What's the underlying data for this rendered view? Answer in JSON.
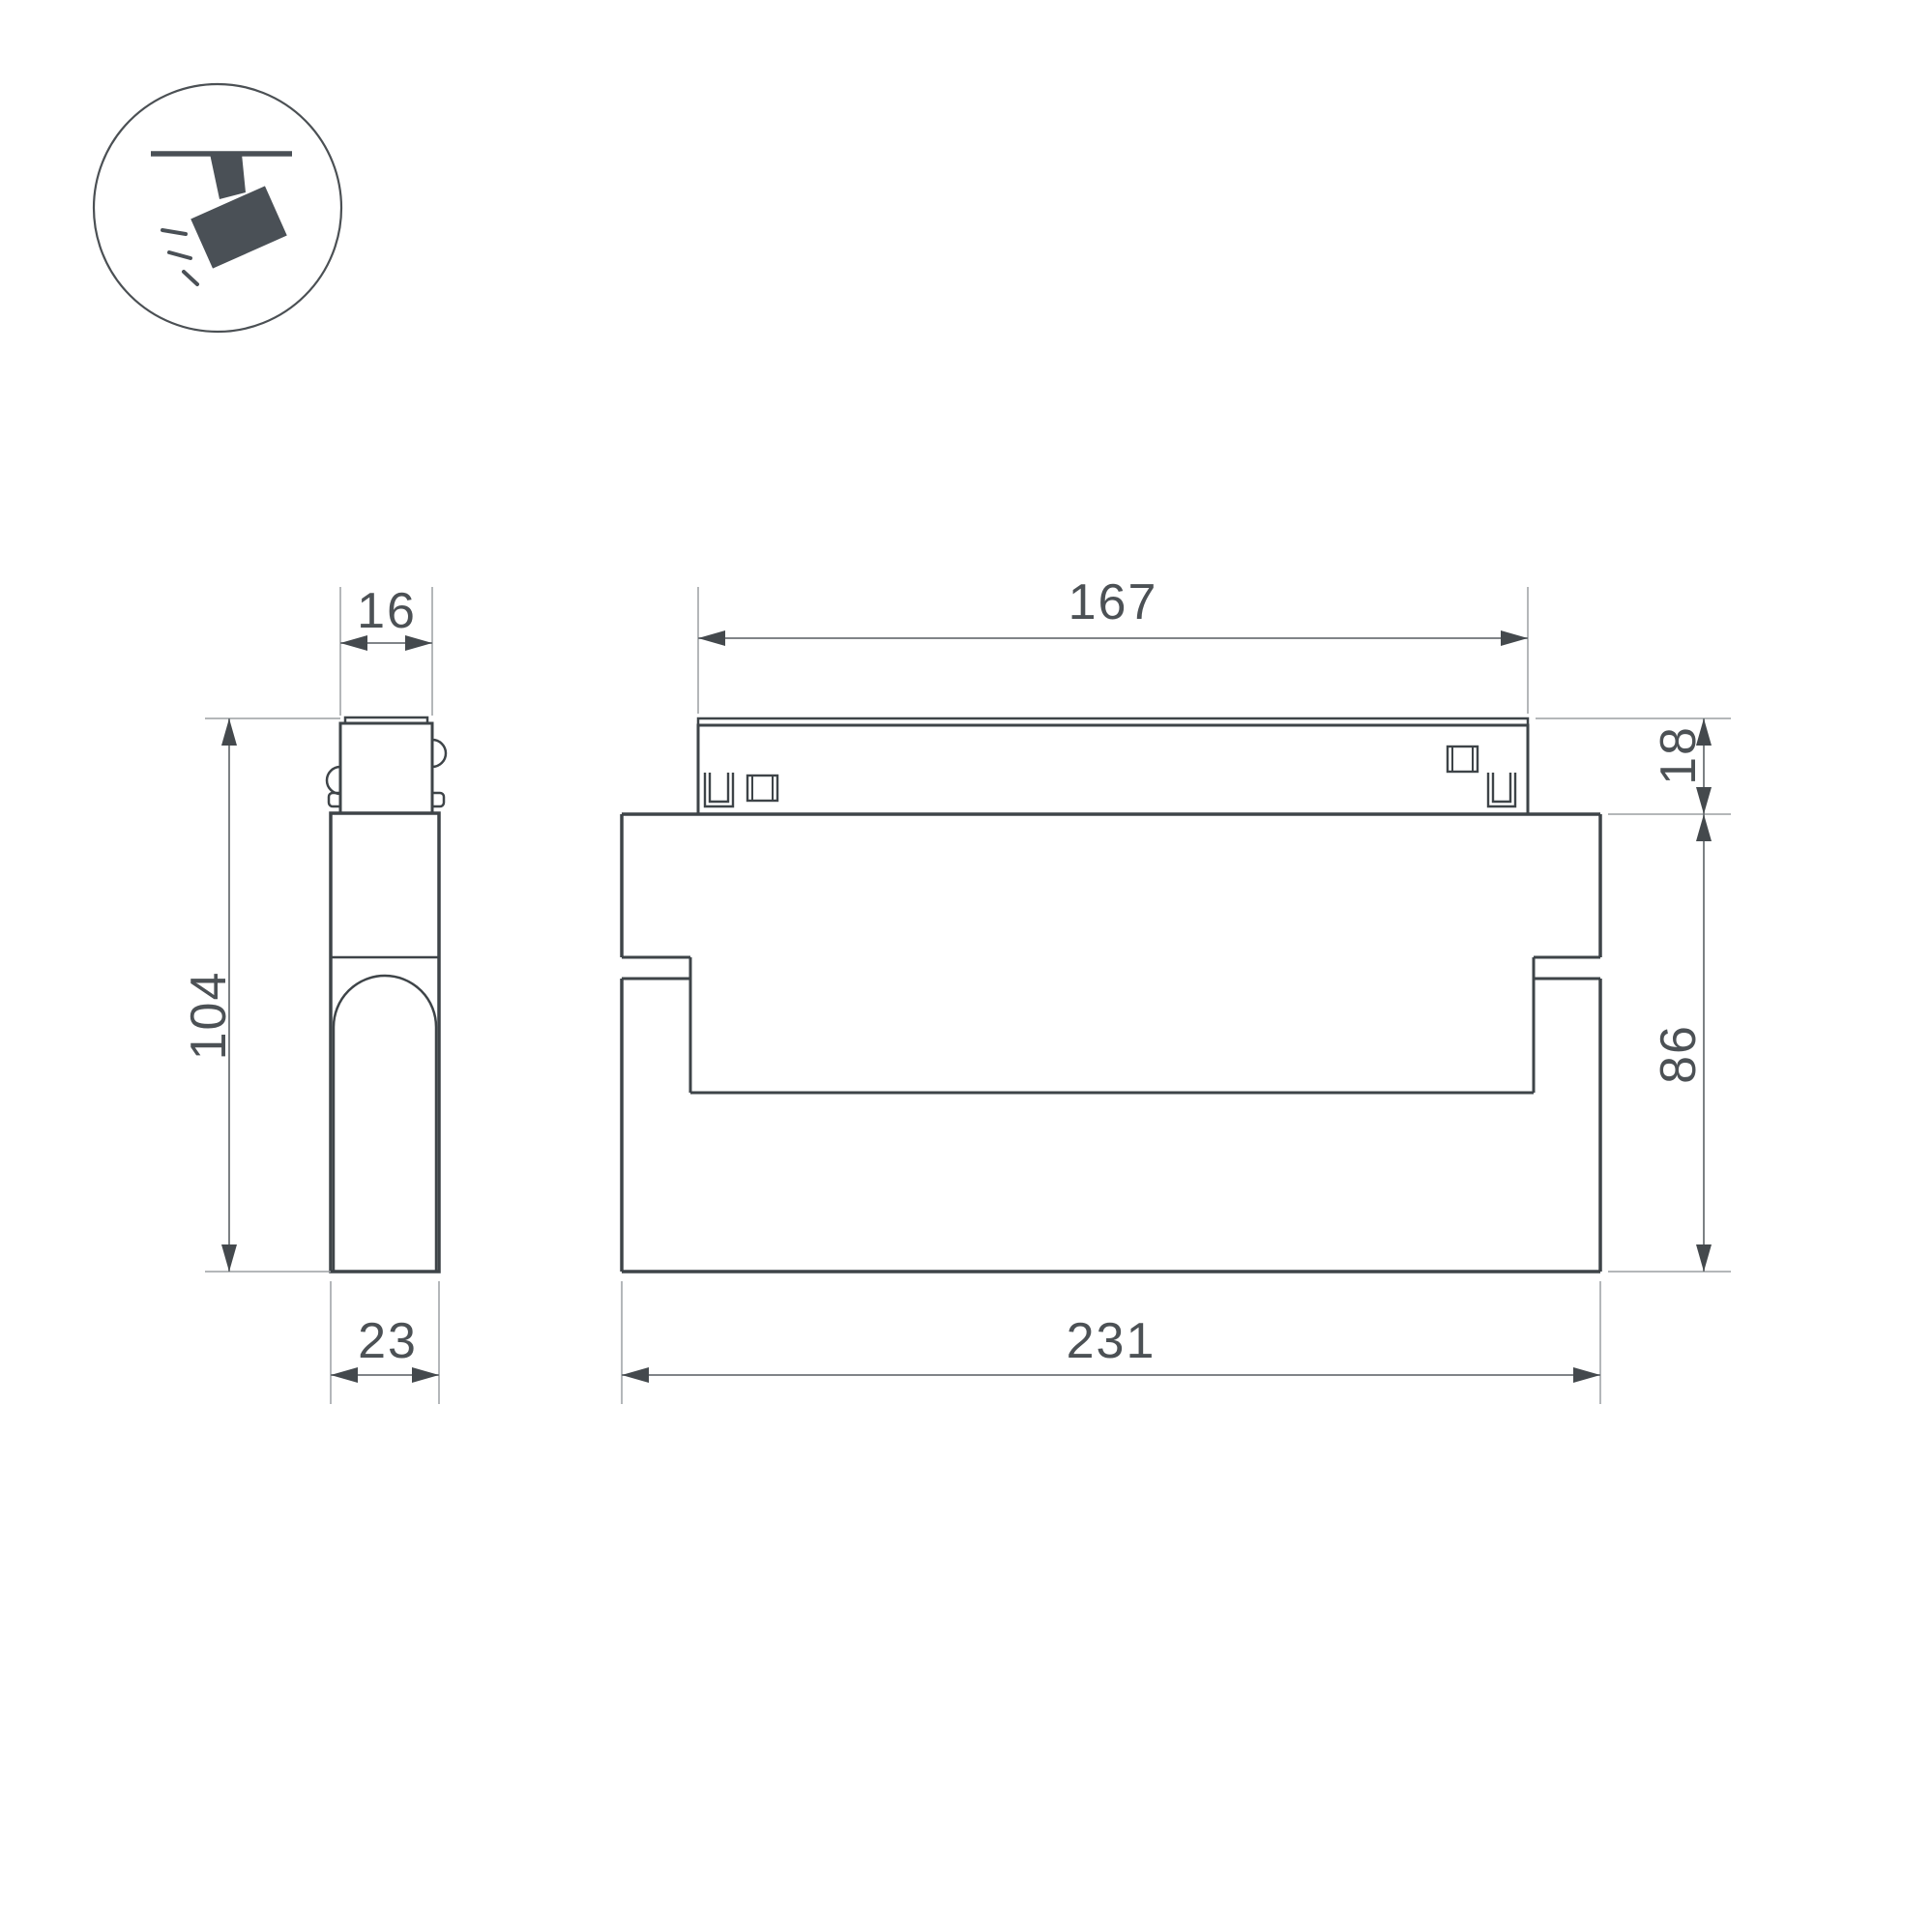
{
  "meta": {
    "type": "technical-drawing",
    "subject": "magnetic-track-folding-spotlight"
  },
  "colors": {
    "background": "#ffffff",
    "shape_line": "#3e4448",
    "dim_line": "#6e7377",
    "ext_line": "#9b9fa2",
    "arrow_fill": "#44494d",
    "text": "#4c5155",
    "icon_fill": "#4a5056"
  },
  "icon": {
    "name": "ceiling-track-spotlight-pictogram"
  },
  "side_view": {
    "dims": {
      "top_width": "16",
      "height": "104",
      "bottom_width": "23"
    }
  },
  "front_view": {
    "dims": {
      "track_width": "167",
      "adapter_height": "18",
      "body_height": "86",
      "body_width": "231"
    }
  }
}
